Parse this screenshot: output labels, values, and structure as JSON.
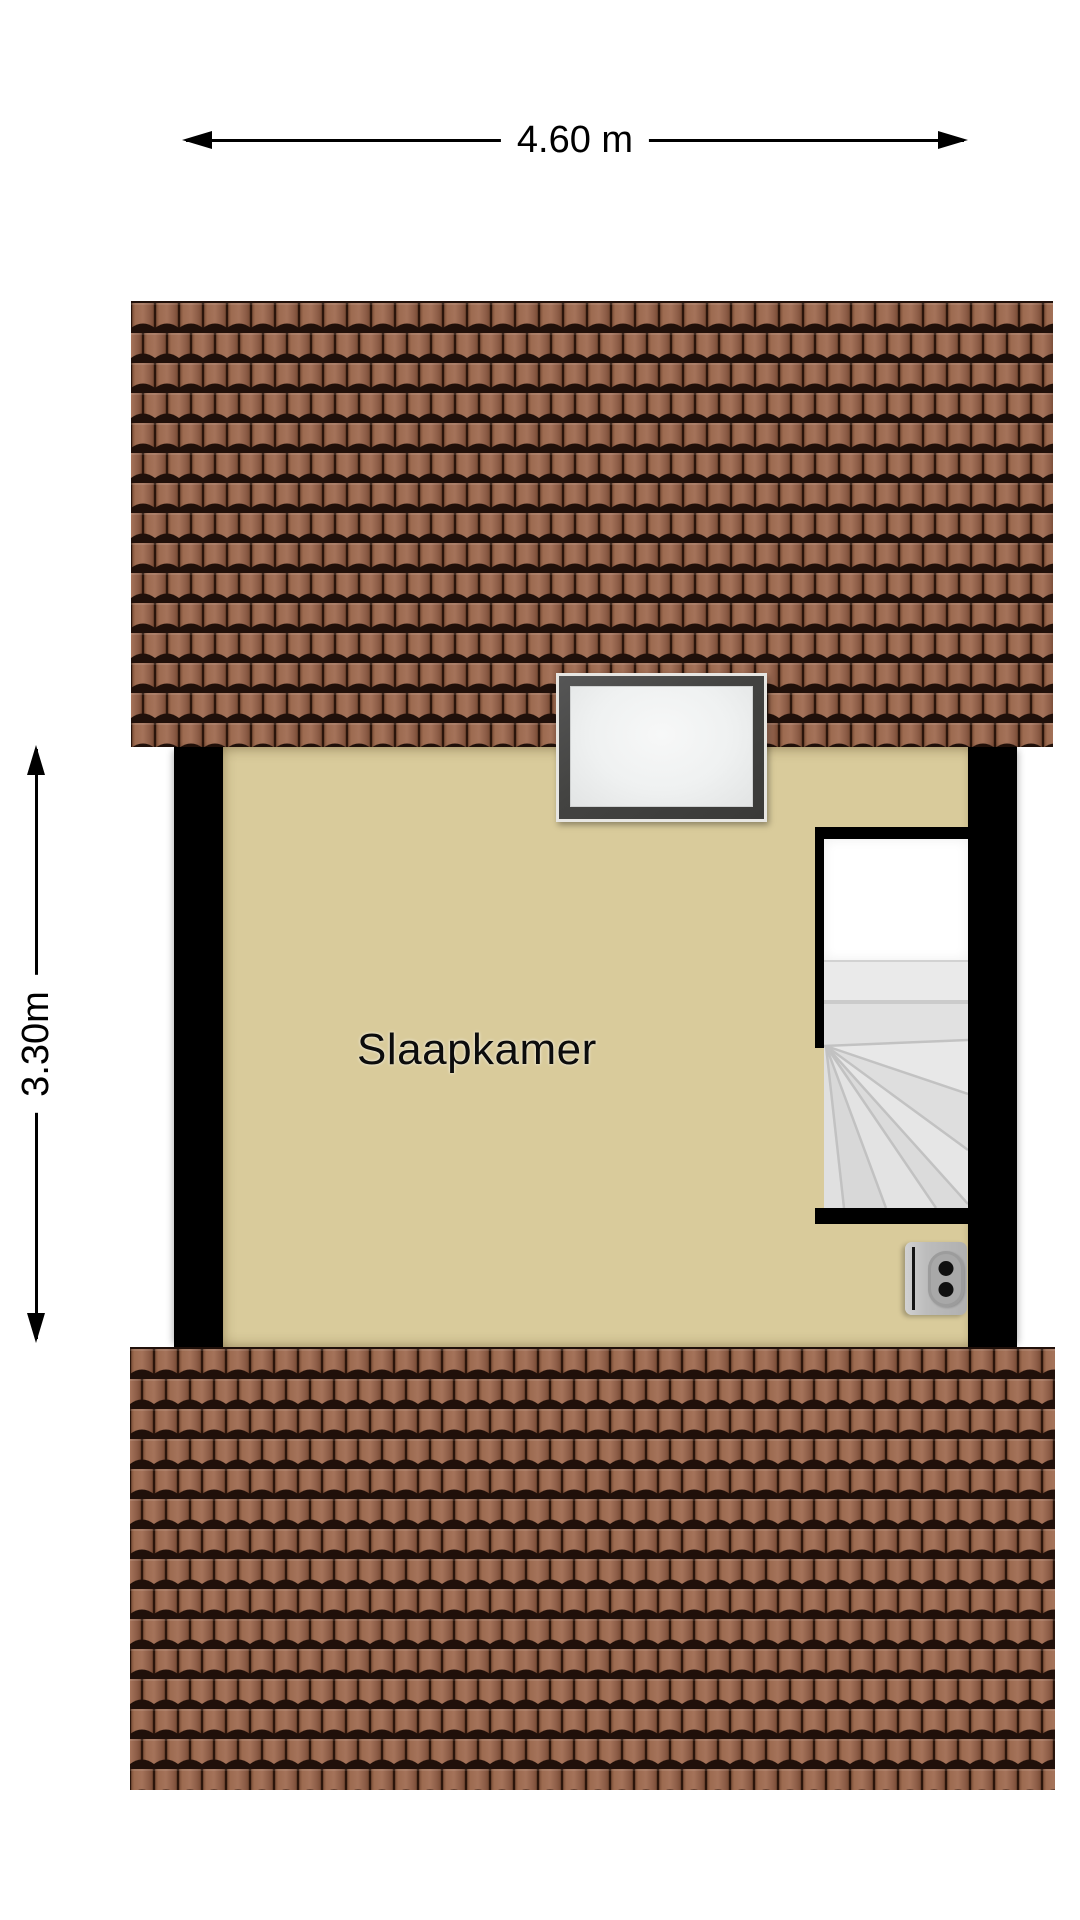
{
  "floorplan": {
    "room": {
      "label": "Slaapkamer"
    },
    "dimensions": {
      "horizontal": "4.60 m",
      "vertical": "3.30m"
    },
    "features": [
      "roof-top",
      "skylight-window",
      "staircase",
      "wall-outlet",
      "bedroom-floor",
      "roof-bottom"
    ]
  },
  "colors": {
    "background": "#ffffff",
    "floor": "#d9cb9b",
    "wall": "#000000",
    "roof_tile": "#98684f",
    "roof_gap": "#20100a",
    "stair_tread": "#e3e3e3",
    "stair_landing": "#ffffff",
    "window_frame": "#454540",
    "window_pane": "#f0f2f2",
    "outlet_body": "#b5b5b5",
    "dimension_text": "#000000"
  }
}
